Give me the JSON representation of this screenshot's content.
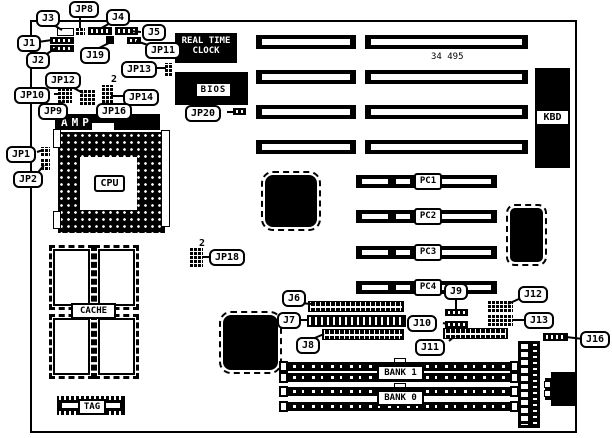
{
  "diagram": {
    "part_number": "34 495",
    "pin1_markers": {
      "jp14": "2",
      "jp18": "2"
    },
    "callouts": {
      "j1": "J1",
      "j2": "J2",
      "j3": "J3",
      "j4": "J4",
      "j5": "J5",
      "j6": "J6",
      "j7": "J7",
      "j8": "J8",
      "j9": "J9",
      "j10": "J10",
      "j11": "J11",
      "j12": "J12",
      "j13": "J13",
      "j16": "J16",
      "j19": "J19",
      "jp1": "JP1",
      "jp2": "JP2",
      "jp8": "JP8",
      "jp9": "JP9",
      "jp10": "JP10",
      "jp11": "JP11",
      "jp12": "JP12",
      "jp13": "JP13",
      "jp14": "JP14",
      "jp16": "JP16",
      "jp18": "JP18",
      "jp20": "JP20"
    },
    "components": {
      "rtc": {
        "line1": "REAL TIME",
        "line2": "CLOCK"
      },
      "bios": "BIOS",
      "kbd": "KBD",
      "cpu": "CPU",
      "socket_brand": "AMP",
      "cache": "CACHE",
      "tag": "TAG"
    },
    "slots": {
      "pci": [
        "PC1",
        "PC2",
        "PC3",
        "PC4"
      ],
      "banks": [
        "BANK 1",
        "BANK 0"
      ]
    },
    "colors": {
      "ink": "#000000",
      "background": "#ffffff"
    }
  }
}
